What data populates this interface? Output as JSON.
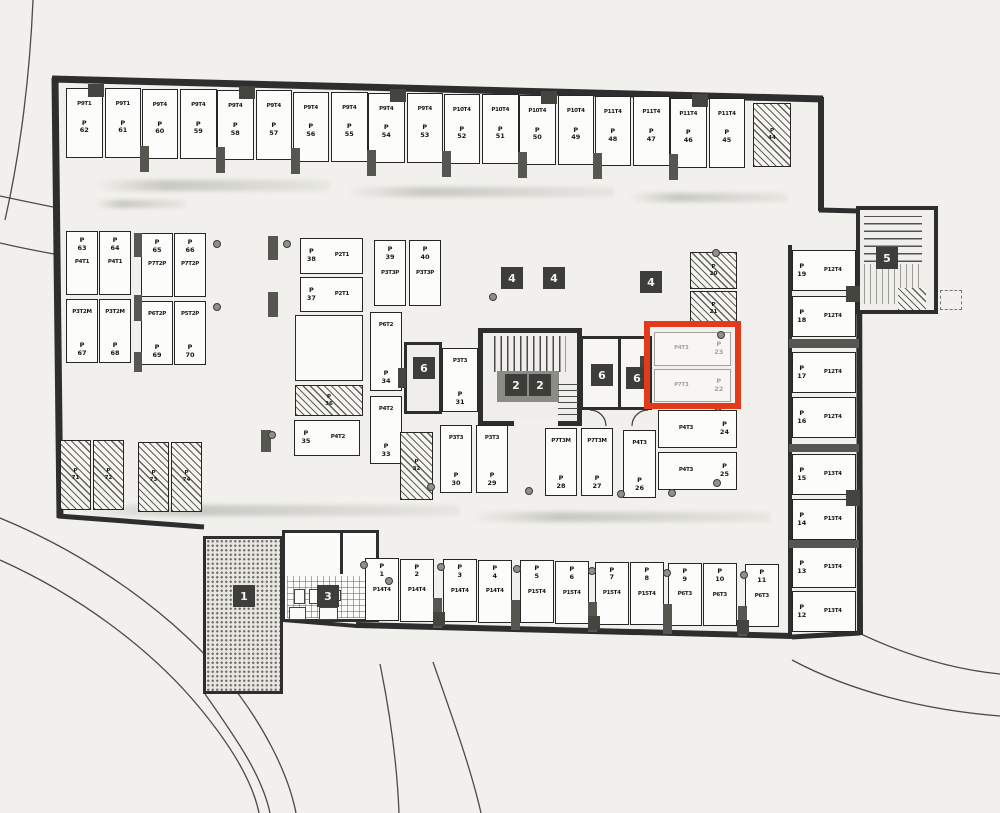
{
  "labels": {
    "p": "P"
  },
  "plan": {
    "highlight_color": "#e4391a"
  },
  "spaces": {
    "top_row": [
      {
        "num": "62",
        "type": "P9T1"
      },
      {
        "num": "61",
        "type": "P9T1"
      },
      {
        "num": "60",
        "type": "P9T4"
      },
      {
        "num": "59",
        "type": "P9T4"
      },
      {
        "num": "58",
        "type": "P9T4"
      },
      {
        "num": "57",
        "type": "P9T4"
      },
      {
        "num": "56",
        "type": "P9T4"
      },
      {
        "num": "55",
        "type": "P9T4"
      },
      {
        "num": "54",
        "type": "P9T4"
      },
      {
        "num": "53",
        "type": "P9T4"
      },
      {
        "num": "52",
        "type": "P10T4"
      },
      {
        "num": "51",
        "type": "P10T4"
      },
      {
        "num": "50",
        "type": "P10T4"
      },
      {
        "num": "49",
        "type": "P10T4"
      },
      {
        "num": "48",
        "type": "P11T4"
      },
      {
        "num": "47",
        "type": "P11T4"
      },
      {
        "num": "46",
        "type": "P11T4"
      },
      {
        "num": "45",
        "type": "P11T4"
      }
    ],
    "hatched_top": [
      {
        "num": "44"
      }
    ],
    "left_block": [
      {
        "num": "63",
        "type": "P4T1"
      },
      {
        "num": "64",
        "type": "P4T1"
      },
      {
        "num": "65",
        "type": "P7T2P"
      },
      {
        "num": "66",
        "type": "P7T2P"
      },
      {
        "num": "67",
        "type": "P3T2M"
      },
      {
        "num": "68",
        "type": "P3T2M"
      },
      {
        "num": "69",
        "type": "P6T2P"
      },
      {
        "num": "70",
        "type": "P5T2P"
      }
    ],
    "left_hatched": [
      {
        "num": "71"
      },
      {
        "num": "72"
      },
      {
        "num": "73"
      },
      {
        "num": "74"
      }
    ],
    "mid": [
      {
        "num": "38",
        "type": "P2T1"
      },
      {
        "num": "37",
        "type": "P2T1"
      },
      {
        "num": "39",
        "type": "P3T3P"
      },
      {
        "num": "40",
        "type": "P3T3P"
      },
      {
        "num": "34",
        "type": "P6T2"
      },
      {
        "num": "33",
        "type": "P4T2"
      },
      {
        "num": "35",
        "type": "P4T2"
      },
      {
        "num": "31",
        "type": "P3T3"
      },
      {
        "num": "30",
        "type": "P3T3"
      },
      {
        "num": "29",
        "type": "P3T3"
      },
      {
        "num": "28",
        "type": "P7T3M"
      },
      {
        "num": "27",
        "type": "P7T3M"
      },
      {
        "num": "26",
        "type": "P4T3"
      },
      {
        "num": "24",
        "type": "P4T3"
      },
      {
        "num": "25",
        "type": "P4T3"
      }
    ],
    "mid_hatched": [
      {
        "num": "36"
      },
      {
        "num": "32"
      },
      {
        "num": "20"
      },
      {
        "num": "21"
      }
    ],
    "highlighted": [
      {
        "num": "23",
        "type": "P4T3"
      },
      {
        "num": "22",
        "type": "P7T3"
      }
    ],
    "right_col": [
      {
        "num": "19",
        "type": "P12T4"
      },
      {
        "num": "18",
        "type": "P12T4"
      },
      {
        "num": "17",
        "type": "P12T4"
      },
      {
        "num": "16",
        "type": "P12T4"
      },
      {
        "num": "15",
        "type": "P13T4"
      },
      {
        "num": "14",
        "type": "P13T4"
      },
      {
        "num": "13",
        "type": "P13T4"
      },
      {
        "num": "12",
        "type": "P13T4"
      }
    ],
    "bottom_row": [
      {
        "num": "1",
        "type": "P14T4"
      },
      {
        "num": "2",
        "type": "P14T4"
      },
      {
        "num": "3",
        "type": "P14T4"
      },
      {
        "num": "4",
        "type": "P14T4"
      },
      {
        "num": "5",
        "type": "P15T4"
      },
      {
        "num": "6",
        "type": "P15T4"
      },
      {
        "num": "7",
        "type": "P15T4"
      },
      {
        "num": "8",
        "type": "P15T4"
      },
      {
        "num": "9",
        "type": "P6T3"
      },
      {
        "num": "10",
        "type": "P6T3"
      },
      {
        "num": "11",
        "type": "P6T3"
      }
    ]
  },
  "markers": [
    {
      "label": "1"
    },
    {
      "label": "3"
    },
    {
      "label": "2"
    },
    {
      "label": "2"
    },
    {
      "label": "4"
    },
    {
      "label": "4"
    },
    {
      "label": "4"
    },
    {
      "label": "5"
    },
    {
      "label": "6"
    },
    {
      "label": "6"
    },
    {
      "label": "6"
    }
  ]
}
